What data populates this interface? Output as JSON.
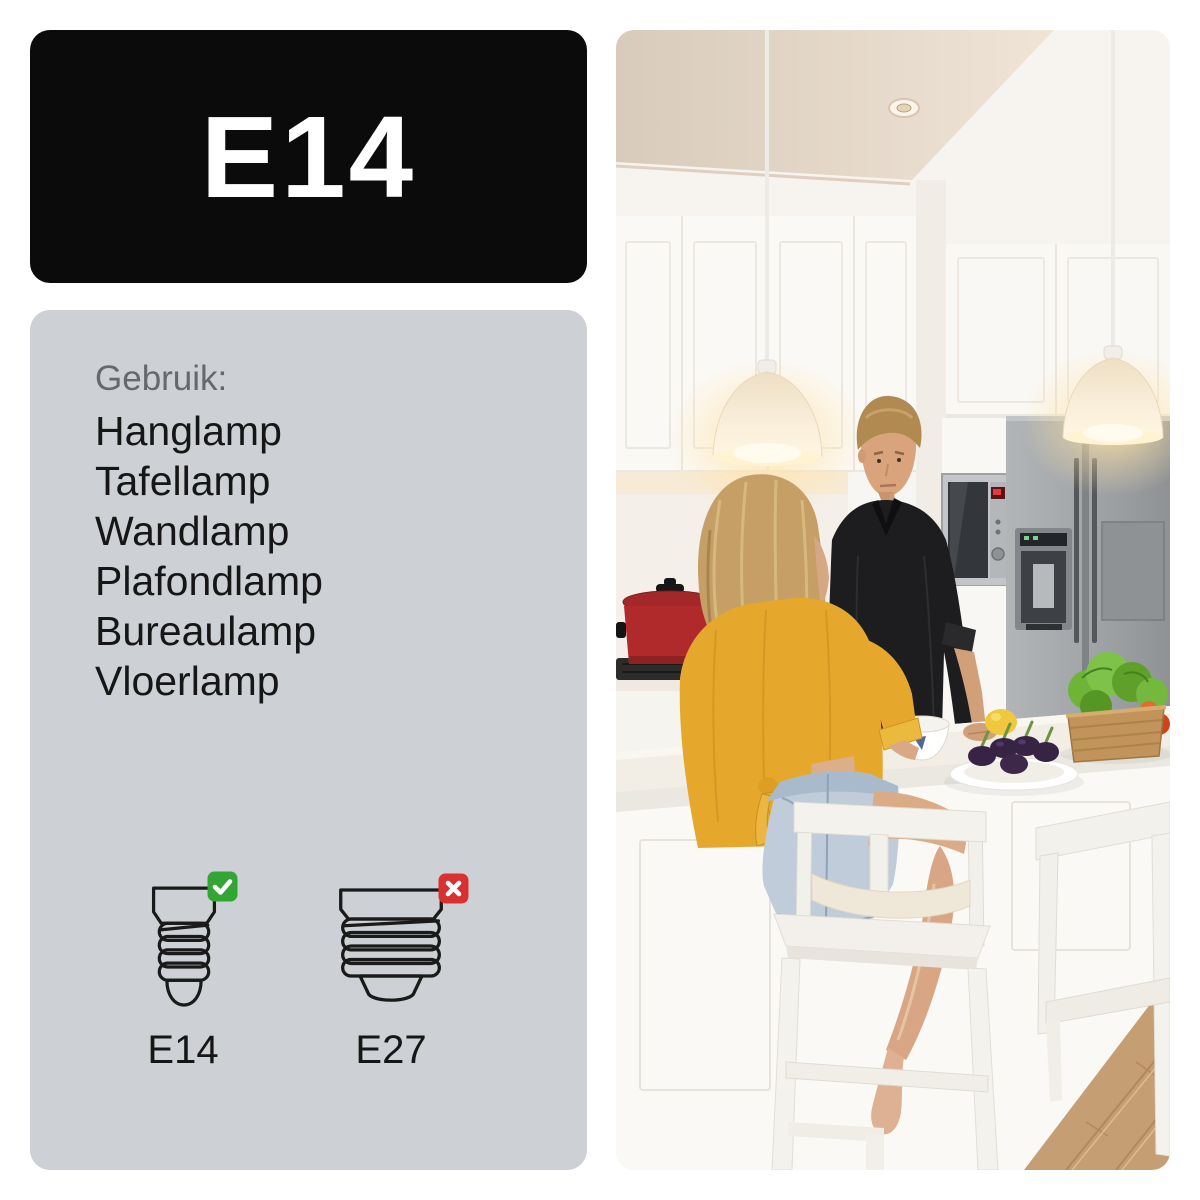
{
  "product_label": {
    "text": "E14"
  },
  "usage_panel": {
    "heading": "Gebruik:",
    "items": [
      "Hanglamp",
      "Tafellamp",
      "Wandlamp",
      "Plafondlamp",
      "Bureaulamp",
      "Vloerlamp"
    ],
    "sockets": [
      {
        "label": "E14",
        "compatible": true,
        "badge": "check"
      },
      {
        "label": "E27",
        "compatible": false,
        "badge": "cross"
      }
    ]
  },
  "photo": {
    "description": "Man and woman talking at a white kitchen island under two glowing pendant lamps, with vegetables on the counter"
  },
  "colors": {
    "label_bg": "#0b0b0b",
    "label_text": "#ffffff",
    "panel_bg": "#cdd1d5",
    "heading_text": "#65696d",
    "body_text": "#161616",
    "check_green": "#33a532",
    "cross_red": "#d93131"
  }
}
